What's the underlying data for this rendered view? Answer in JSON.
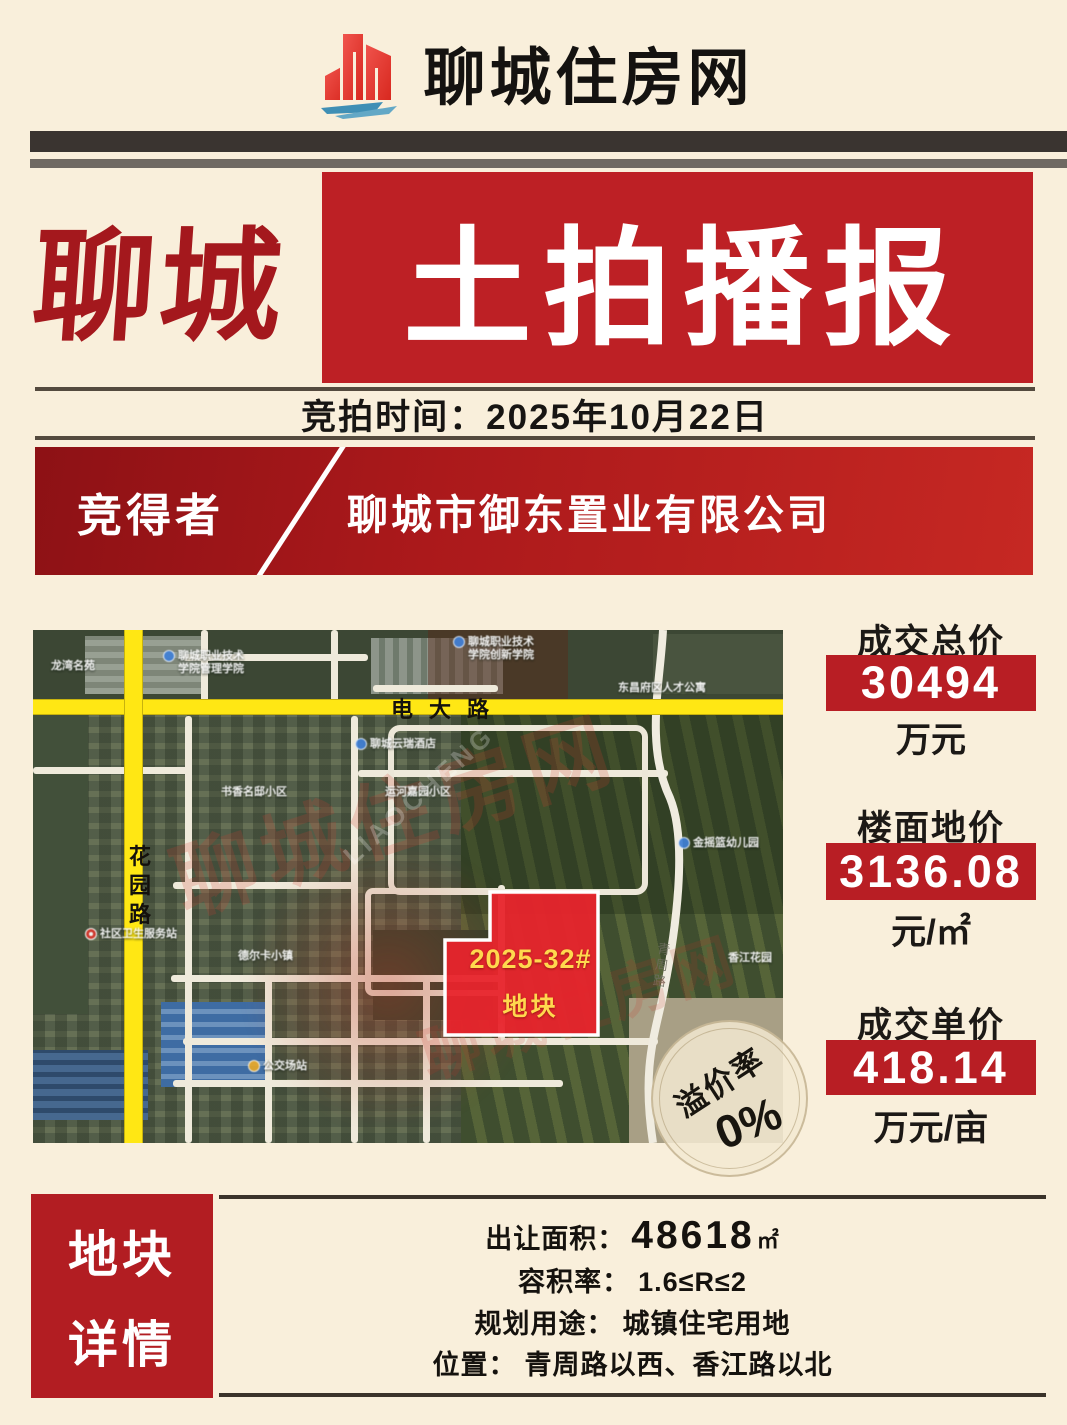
{
  "header": {
    "site_title": "聊城住房网"
  },
  "title": {
    "left": "聊城",
    "boxed": "土拍播报"
  },
  "auction_time": {
    "label": "竞拍时间：",
    "value": "2025年10月22日"
  },
  "winner": {
    "label": "竞得者",
    "name": "聊城市御东置业有限公司"
  },
  "map": {
    "plot": {
      "line1": "2025-32#",
      "line2": "地块"
    },
    "roads": {
      "horizontal": "电大路",
      "vertical": "花\n园\n路",
      "side": "青周路"
    },
    "premium": {
      "label": "溢价率",
      "value": "0%"
    },
    "watermark1": "聊城住房网",
    "watermark2": "LIAOCHENG",
    "watermark3": "聊城住房网",
    "pois": [
      {
        "text": "聊城职业技术\n学院管理学院"
      },
      {
        "text": "聊城职业技术\n学院创新学院"
      },
      {
        "text": "东昌府区人才公寓"
      },
      {
        "text": "聊城云瑞酒店"
      },
      {
        "text": "金摇篮幼儿园"
      },
      {
        "text": "书香名邸小区"
      },
      {
        "text": "运河嘉园小区"
      },
      {
        "text": "德尔卡小镇"
      },
      {
        "text": "社区卫生服务站"
      },
      {
        "text": "公交场站"
      },
      {
        "text": "香江花园"
      },
      {
        "text": "龙湾名苑"
      }
    ]
  },
  "stats": [
    {
      "label": "成交总价",
      "value": "30494",
      "unit": "万元"
    },
    {
      "label": "楼面地价",
      "value": "3136.08",
      "unit": "元/㎡"
    },
    {
      "label": "成交单价",
      "value": "418.14",
      "unit": "万元/亩"
    }
  ],
  "details": {
    "title_line1": "地块",
    "title_line2": "详情",
    "rows": [
      {
        "label": "出让面积：",
        "value": "48618",
        "unit": "㎡"
      },
      {
        "label": "容积率：",
        "value": "1.6≤R≤2"
      },
      {
        "label": "规划用途：",
        "value": "城镇住宅用地"
      },
      {
        "label": "位置：",
        "value": "青周路以西、香江路以北"
      }
    ]
  }
}
